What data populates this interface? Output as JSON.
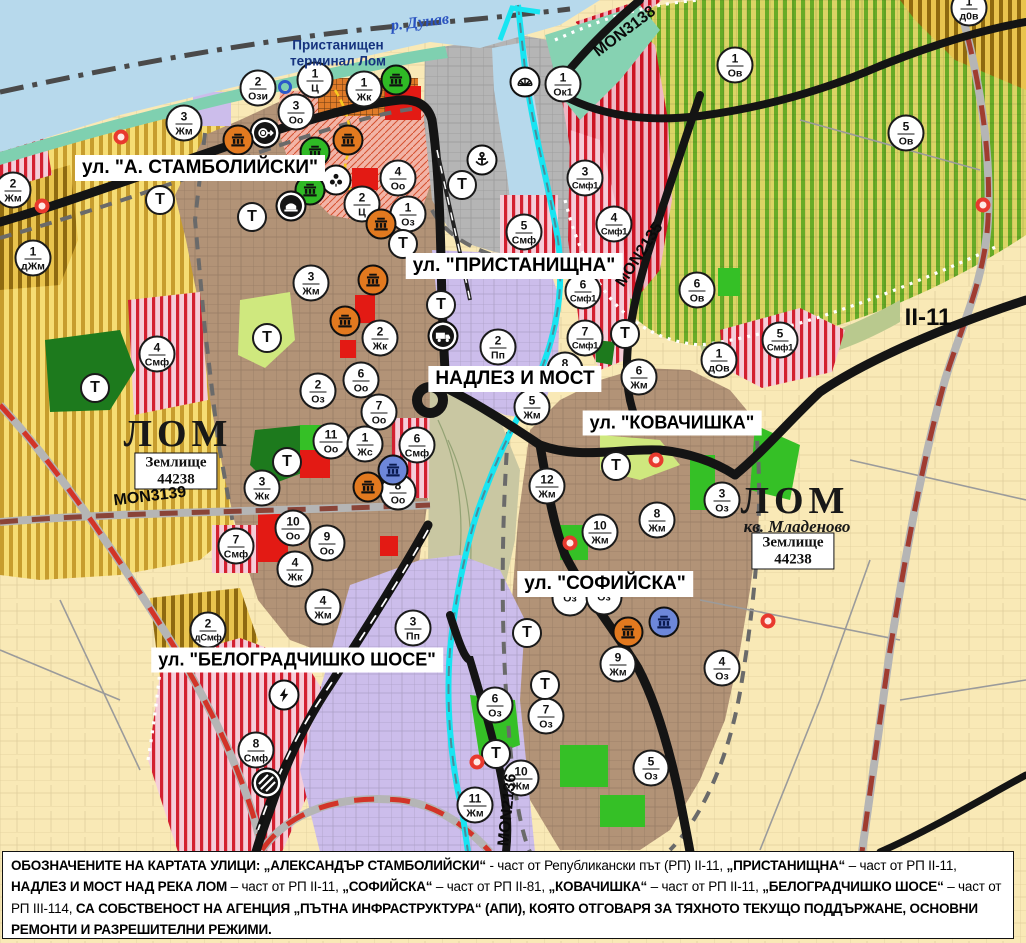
{
  "map": {
    "water_label": "р. Дунав",
    "port_label": "Пристанищен терминал Лом",
    "city_label_left": "ЛОМ",
    "city_label_right": "ЛОМ",
    "quarter_label": "кв. Младеново",
    "land_boxes": [
      {
        "line1": "Землище",
        "line2": "44238"
      },
      {
        "line1": "Землище",
        "line2": "44238"
      }
    ],
    "road_labels": {
      "mon3138": "MON3138",
      "mon3139": "MON3139",
      "mon2135": "MON2135",
      "mon2136": "MON2136",
      "ii11": "II-11"
    },
    "street_labels": [
      {
        "id": "a-stambolijski",
        "text": "ул. \"А. СТАМБОЛИЙСКИ\"",
        "x": 200,
        "y": 168,
        "fs": 19
      },
      {
        "id": "pristanishtna",
        "text": "ул. \"ПРИСТАНИЩНА\"",
        "x": 514,
        "y": 266,
        "fs": 19
      },
      {
        "id": "nadlez-i-most",
        "text": "НАДЛЕЗ И МОСТ",
        "x": 515,
        "y": 379,
        "fs": 19
      },
      {
        "id": "kovachishka",
        "text": "ул. \"КОВАЧИШКА\"",
        "x": 672,
        "y": 423,
        "fs": 18
      },
      {
        "id": "sofijska",
        "text": "ул. \"СОФИЙСКА\"",
        "x": 605,
        "y": 584,
        "fs": 19
      },
      {
        "id": "belogradchishko-shose",
        "text": "ул. \"БЕЛОГРАДЧИШКО ШОСЕ\"",
        "x": 297,
        "y": 660,
        "fs": 18
      }
    ],
    "zone_markers": [
      {
        "num": "1",
        "code": "д0в",
        "x": 969,
        "y": 8
      },
      {
        "num": "1",
        "code": "Ц",
        "x": 315,
        "y": 80
      },
      {
        "num": "2",
        "code": "Ози",
        "x": 258,
        "y": 88
      },
      {
        "num": "1",
        "code": "Жк",
        "x": 364,
        "y": 89
      },
      {
        "num": "1",
        "code": "Ок1",
        "x": 563,
        "y": 84
      },
      {
        "num": "1",
        "code": "Ов",
        "x": 735,
        "y": 65
      },
      {
        "num": "3",
        "code": "Оо",
        "x": 296,
        "y": 112
      },
      {
        "num": "3",
        "code": "Жм",
        "x": 184,
        "y": 123
      },
      {
        "num": "5",
        "code": "Ов",
        "x": 906,
        "y": 133
      },
      {
        "num": "4",
        "code": "Оо",
        "x": 398,
        "y": 178
      },
      {
        "num": "3",
        "code": "Смф1",
        "x": 585,
        "y": 178
      },
      {
        "num": "2",
        "code": "Жм",
        "x": 13,
        "y": 190
      },
      {
        "num": "2",
        "code": "Ц",
        "x": 362,
        "y": 204
      },
      {
        "num": "1",
        "code": "Оз",
        "x": 408,
        "y": 214
      },
      {
        "num": "4",
        "code": "Смф1",
        "x": 614,
        "y": 224
      },
      {
        "num": "5",
        "code": "Смф",
        "x": 524,
        "y": 232
      },
      {
        "num": "1",
        "code": "дЖм",
        "x": 33,
        "y": 258
      },
      {
        "num": "3",
        "code": "Жм",
        "x": 311,
        "y": 283
      },
      {
        "num": "6",
        "code": "Ов",
        "x": 697,
        "y": 290
      },
      {
        "num": "6",
        "code": "Смф1",
        "x": 583,
        "y": 291
      },
      {
        "num": "2",
        "code": "Жк",
        "x": 380,
        "y": 338
      },
      {
        "num": "7",
        "code": "Смф1",
        "x": 585,
        "y": 338
      },
      {
        "num": "5",
        "code": "Смф1",
        "x": 780,
        "y": 340
      },
      {
        "num": "1",
        "code": "дОв",
        "x": 719,
        "y": 360
      },
      {
        "num": "2",
        "code": "Пп",
        "x": 498,
        "y": 347
      },
      {
        "num": "4",
        "code": "Смф",
        "x": 157,
        "y": 354
      },
      {
        "num": "8",
        "code": "Жм",
        "x": 565,
        "y": 370
      },
      {
        "num": "6",
        "code": "Жм",
        "x": 639,
        "y": 377
      },
      {
        "num": "6",
        "code": "Оо",
        "x": 361,
        "y": 380
      },
      {
        "num": "2",
        "code": "Оз",
        "x": 318,
        "y": 391
      },
      {
        "num": "5",
        "code": "Жм",
        "x": 532,
        "y": 407
      },
      {
        "num": "7",
        "code": "Оо",
        "x": 379,
        "y": 412
      },
      {
        "num": "11",
        "code": "Оо",
        "x": 331,
        "y": 441
      },
      {
        "num": "1",
        "code": "Жс",
        "x": 365,
        "y": 444
      },
      {
        "num": "6",
        "code": "Смф",
        "x": 417,
        "y": 445
      },
      {
        "num": "12",
        "code": "Жм",
        "x": 547,
        "y": 486
      },
      {
        "num": "3",
        "code": "Жк",
        "x": 262,
        "y": 488
      },
      {
        "num": "8",
        "code": "Оо",
        "x": 398,
        "y": 492
      },
      {
        "num": "3",
        "code": "Оз",
        "x": 722,
        "y": 500
      },
      {
        "num": "8",
        "code": "Жм",
        "x": 657,
        "y": 520
      },
      {
        "num": "10",
        "code": "Оо",
        "x": 293,
        "y": 528
      },
      {
        "num": "10",
        "code": "Жм",
        "x": 600,
        "y": 532
      },
      {
        "num": "9",
        "code": "Оо",
        "x": 327,
        "y": 543
      },
      {
        "num": "7",
        "code": "Смф",
        "x": 236,
        "y": 546
      },
      {
        "num": "4",
        "code": "Жк",
        "x": 295,
        "y": 569
      },
      {
        "num": "",
        "code": "Оз",
        "x": 570,
        "y": 598
      },
      {
        "num": "",
        "code": "Оз",
        "x": 604,
        "y": 597
      },
      {
        "num": "4",
        "code": "Жм",
        "x": 323,
        "y": 607
      },
      {
        "num": "3",
        "code": "Пп",
        "x": 413,
        "y": 628
      },
      {
        "num": "2",
        "code": "дСмф",
        "x": 208,
        "y": 630
      },
      {
        "num": "9",
        "code": "Жм",
        "x": 618,
        "y": 664
      },
      {
        "num": "4",
        "code": "Оз",
        "x": 722,
        "y": 668
      },
      {
        "num": "6",
        "code": "Оз",
        "x": 495,
        "y": 705
      },
      {
        "num": "7",
        "code": "Оз",
        "x": 546,
        "y": 716
      },
      {
        "num": "8",
        "code": "Смф",
        "x": 256,
        "y": 750
      },
      {
        "num": "5",
        "code": "Оз",
        "x": 651,
        "y": 768
      },
      {
        "num": "10",
        "code": "Жм",
        "x": 521,
        "y": 778
      },
      {
        "num": "11",
        "code": "Жм",
        "x": 475,
        "y": 805
      }
    ],
    "t_markers": [
      {
        "x": 160,
        "y": 200
      },
      {
        "x": 252,
        "y": 217
      },
      {
        "x": 462,
        "y": 185
      },
      {
        "x": 403,
        "y": 244
      },
      {
        "x": 267,
        "y": 338
      },
      {
        "x": 441,
        "y": 305
      },
      {
        "x": 625,
        "y": 334
      },
      {
        "x": 95,
        "y": 388
      },
      {
        "x": 287,
        "y": 462
      },
      {
        "x": 616,
        "y": 466
      },
      {
        "x": 527,
        "y": 633
      },
      {
        "x": 545,
        "y": 685
      },
      {
        "x": 496,
        "y": 754
      }
    ],
    "t_label": "Т",
    "icon_markers": [
      {
        "type": "heritage",
        "variant": "green",
        "x": 396,
        "y": 80
      },
      {
        "type": "fan",
        "variant": "light",
        "x": 525,
        "y": 82
      },
      {
        "type": "arrow-target",
        "variant": "dark",
        "x": 265,
        "y": 133
      },
      {
        "type": "heritage",
        "variant": "orange",
        "x": 238,
        "y": 140
      },
      {
        "type": "heritage",
        "variant": "orange",
        "x": 348,
        "y": 140
      },
      {
        "type": "heritage",
        "variant": "green",
        "x": 315,
        "y": 152
      },
      {
        "type": "anchor",
        "variant": "light",
        "x": 482,
        "y": 160
      },
      {
        "type": "trefoil",
        "variant": "light",
        "x": 336,
        "y": 180
      },
      {
        "type": "heritage",
        "variant": "green",
        "x": 310,
        "y": 190
      },
      {
        "type": "dome",
        "variant": "dark",
        "x": 291,
        "y": 206
      },
      {
        "type": "heritage",
        "variant": "orange",
        "x": 381,
        "y": 224
      },
      {
        "type": "heritage",
        "variant": "orange",
        "x": 373,
        "y": 280
      },
      {
        "type": "heritage",
        "variant": "orange",
        "x": 345,
        "y": 321
      },
      {
        "type": "truck",
        "variant": "dark",
        "x": 443,
        "y": 336
      },
      {
        "type": "heritage",
        "variant": "blue",
        "x": 393,
        "y": 470
      },
      {
        "type": "heritage",
        "variant": "orange",
        "x": 368,
        "y": 487
      },
      {
        "type": "heritage",
        "variant": "blue",
        "x": 664,
        "y": 622
      },
      {
        "type": "heritage",
        "variant": "orange",
        "x": 628,
        "y": 632
      },
      {
        "type": "lightning",
        "variant": "light",
        "x": 284,
        "y": 695
      },
      {
        "type": "rail-hatch",
        "variant": "dark",
        "x": 267,
        "y": 783
      }
    ],
    "dot_markers": [
      {
        "type": "red",
        "x": 121,
        "y": 137
      },
      {
        "type": "blue-ring",
        "x": 285,
        "y": 87
      },
      {
        "type": "red",
        "x": 42,
        "y": 206
      },
      {
        "type": "red",
        "x": 983,
        "y": 205
      },
      {
        "type": "red",
        "x": 656,
        "y": 460
      },
      {
        "type": "red",
        "x": 570,
        "y": 543
      },
      {
        "type": "red",
        "x": 768,
        "y": 621
      },
      {
        "type": "red",
        "x": 477,
        "y": 762
      }
    ]
  },
  "footer": {
    "segments": [
      {
        "t": "ОБОЗНАЧЕНИТЕ НА КАРТАТА УЛИЦИ: „АЛЕКСАНДЪР СТАМБОЛИЙСКИ“",
        "b": true
      },
      {
        "t": " - част от Републикански път (РП) II-11, ",
        "b": false
      },
      {
        "t": "„ПРИСТАНИЩНА“",
        "b": true
      },
      {
        "t": " – част от РП II-11, ",
        "b": false
      },
      {
        "t": "НАДЛЕЗ И МОСТ НАД РЕКА ЛОМ",
        "b": true
      },
      {
        "t": " – част от РП II-11, ",
        "b": false
      },
      {
        "t": "„СОФИЙСКА“",
        "b": true
      },
      {
        "t": " – част от РП II-81, ",
        "b": false
      },
      {
        "t": "„КОВАЧИШКА“",
        "b": true
      },
      {
        "t": " – част от РП II-11, ",
        "b": false
      },
      {
        "t": "„БЕЛОГРАДЧИШКО ШОСЕ“",
        "b": true
      },
      {
        "t": " – част от РП III-114, ",
        "b": false
      },
      {
        "t": "СА СОБСТВЕНОСТ НА АГЕНЦИЯ „ПЪТНА ИНФРАСТРУКТУРА“ (АПИ), КОЯТО ОТГОВАРЯ ЗА ТЯХНОТО ТЕКУЩО ПОДДЪРЖАНЕ, ОСНОВНИ РЕМОНТИ И РАЗРЕШИТЕЛНИ РЕЖИМИ.",
        "b": true
      }
    ]
  },
  "colors": {
    "water": "#b7d9ec",
    "shore": "#7fd0b0",
    "urban_brown": "#b29377",
    "vineyard_yellow": "#f6dd74",
    "vineyard_stripe": "#c79d2e",
    "orchard_green_bg": "#dbd465",
    "orchard_green_stripe": "#67ab27",
    "fields_pale": "#f9e9b6",
    "industry_purple": "#ccbdeb",
    "smf_pink": "#f5cdd9",
    "smf_red_stripe": "#d32030",
    "port_gray": "#b5b5b5",
    "road_black": "#141414",
    "river_cyan": "#17e5f2",
    "park_dark_green": "#1d7a1d",
    "park_bright_green": "#35c026",
    "heritage_orange": "#e2791f",
    "heritage_green": "#2fba25",
    "heritage_blue": "#6d87d9"
  }
}
